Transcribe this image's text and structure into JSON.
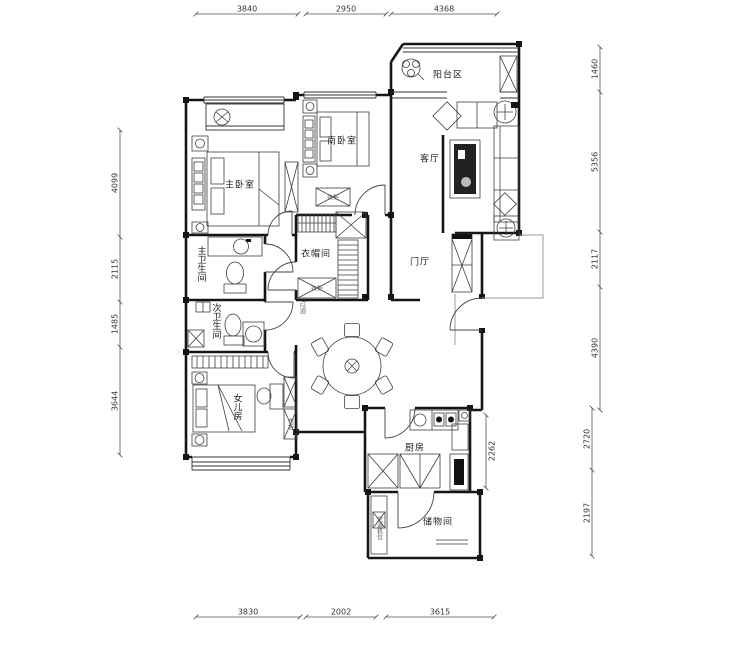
{
  "rooms": {
    "balcony": "阳台区",
    "living": "客厅",
    "south_bedroom": "南卧室",
    "master_bedroom": "主卧室",
    "master_bath": "主卫生间",
    "second_bath": "次卫生间",
    "cloakroom": "衣帽间",
    "foyer": "门厅",
    "daughter_room": "女儿房",
    "kitchen": "厨房",
    "storage": "储物间",
    "corridor": "过道",
    "ac_shaft": "空调机位",
    "wardrobe": "衣柜"
  },
  "dimensions": {
    "top": [
      "3840",
      "2950",
      "4368"
    ],
    "bottom": [
      "3830",
      "2002",
      "3615"
    ],
    "left": [
      "4099",
      "2115",
      "1485",
      "3644"
    ],
    "right": [
      "1460",
      "5356",
      "2117",
      "4390",
      "2720",
      "2197"
    ],
    "kitchen_side": "2262"
  },
  "colors": {
    "wall": "#151515",
    "furniture_line": "#3f3f3f",
    "dim_line": "#555555",
    "background": "#ffffff"
  }
}
